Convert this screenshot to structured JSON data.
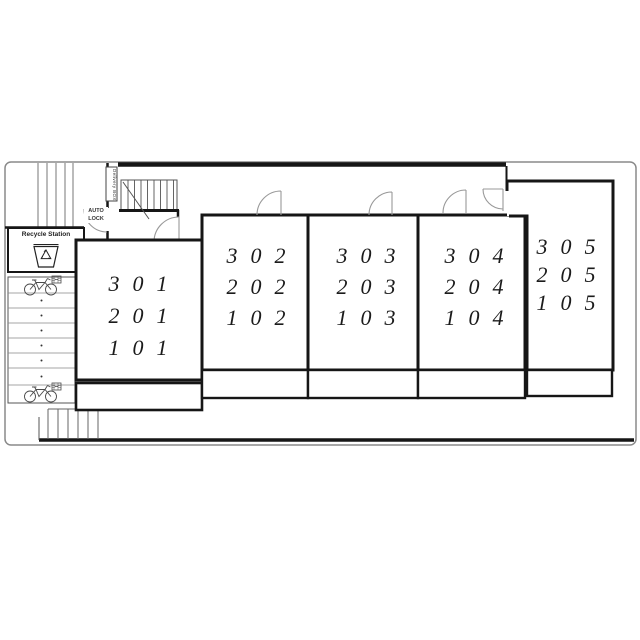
{
  "plan": {
    "units": [
      {
        "name": "unit-301",
        "floors": [
          "301",
          "201",
          "101"
        ]
      },
      {
        "name": "unit-302",
        "floors": [
          "302",
          "202",
          "102"
        ]
      },
      {
        "name": "unit-303",
        "floors": [
          "303",
          "203",
          "103"
        ]
      },
      {
        "name": "unit-304",
        "floors": [
          "304",
          "204",
          "104"
        ]
      },
      {
        "name": "unit-305",
        "floors": [
          "305",
          "205",
          "105"
        ]
      }
    ],
    "facilities": {
      "recycle_station": "Recycle Station",
      "auto_lock_line1": "AUTO",
      "auto_lock_line2": "LOCK",
      "delivery_box": "Delivery BOX"
    },
    "colors": {
      "wall": "#161616",
      "thin_line": "#555555",
      "door_arc": "#999999",
      "site_border": "#8a8a8a",
      "background": "#ffffff"
    }
  }
}
